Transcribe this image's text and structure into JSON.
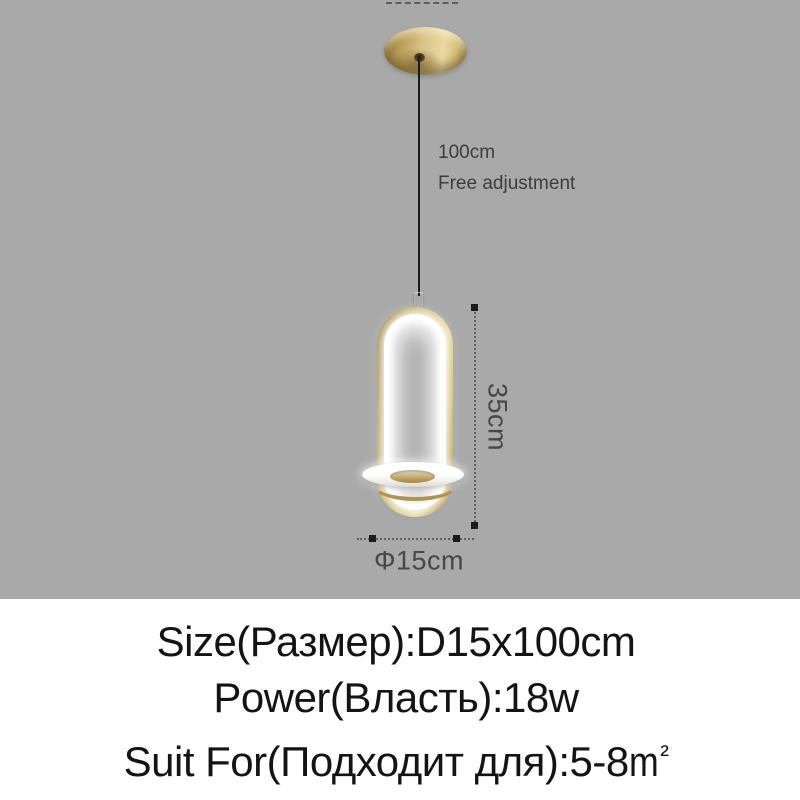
{
  "image_type": "pendant-lamp product dimension diagram",
  "colors": {
    "background_gray": "#a9a9a9",
    "background_white": "#ffffff",
    "gold_dark": "#9a7f43",
    "gold_mid": "#c9ad6a",
    "gold_light": "#e9dca6",
    "led_white": "#ffffff",
    "wire_black": "#1b1b1b",
    "dimension_text": "#474747",
    "spec_text": "#141414"
  },
  "annotations": {
    "cord_length": "100cm",
    "cord_note": "Free adjustment",
    "lamp_height": "35cm",
    "lamp_diameter": "Φ15cm"
  },
  "specs": {
    "size_label": "Size(Размер):D15x100cm",
    "power_label": "Power(Власть):18w",
    "suit_label_prefix": "Suit For(Подходит для):5-8",
    "suit_unit_base": "m",
    "suit_unit_exponent": "²"
  }
}
